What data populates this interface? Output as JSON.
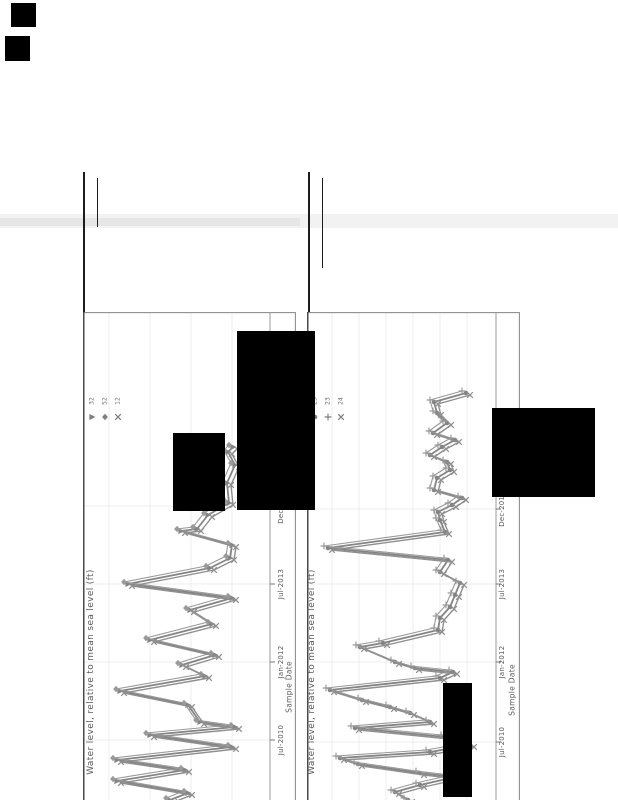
{
  "page": {
    "width": 618,
    "height": 800,
    "background": "#ffffff"
  },
  "colors": {
    "line_gray": "#868686",
    "marker_gray": "#7f7f7f",
    "border_gray": "#8e8e8e",
    "dark_edge": "#3a3a3a",
    "grid_light": "#efece8",
    "text_gray": "#575757",
    "redaction": "#000000"
  },
  "scan_artifacts": {
    "redaction_boxes": [
      {
        "x": 11,
        "y": 3,
        "w": 25,
        "h": 24
      },
      {
        "x": 5,
        "y": 36,
        "w": 25,
        "h": 25
      },
      {
        "x": 237,
        "y": 331,
        "w": 78,
        "h": 179
      },
      {
        "x": 173,
        "y": 433,
        "w": 52,
        "h": 78
      },
      {
        "x": 492,
        "y": 408,
        "w": 103,
        "h": 89
      },
      {
        "x": 443,
        "y": 683,
        "w": 29,
        "h": 114
      }
    ],
    "vertical_rules": [
      {
        "x": 83,
        "y": 172,
        "w": 1.5,
        "h": 140
      },
      {
        "x": 97,
        "y": 178,
        "w": 1.2,
        "h": 49
      },
      {
        "x": 308,
        "y": 172,
        "w": 1.5,
        "h": 140
      },
      {
        "x": 322,
        "y": 178,
        "w": 1.2,
        "h": 90
      }
    ],
    "gray_band": {
      "x": 0,
      "y": 214,
      "w": 618,
      "h": 14,
      "color": "#f2f2f2",
      "left_segment": {
        "x": 0,
        "y": 4,
        "w": 300,
        "h": 8,
        "color": "#e6e6e6"
      }
    }
  },
  "chart_data": [
    {
      "type": "line",
      "orientation": "rotated 90deg counterclockwise; time axis runs bottom-to-top of page",
      "box": {
        "x": 83,
        "y": 312,
        "w": 212,
        "h": 488
      },
      "axis_x": 270,
      "ylabel": "Water level, relative to mean sea level (ft)",
      "ylabel_pos": {
        "cx": 91,
        "cy": 672
      },
      "xlabel": "Sample Date",
      "xlabel_pos": {
        "cx": 289,
        "cy": 687
      },
      "tick_label_cx": 281,
      "tick_labels": [
        {
          "label": "Jul-2010",
          "y": 740
        },
        {
          "label": "Jan-2012",
          "y": 662
        },
        {
          "label": "Jul-2013",
          "y": 584
        },
        {
          "label": "Dec-2014",
          "y": 506
        }
      ],
      "gridlines_x": [
        109,
        150,
        191,
        232
      ],
      "legend": {
        "x": 86,
        "y": 411,
        "label_cy": 401,
        "step": 13,
        "entries": [
          {
            "marker": "triangle-right",
            "label": "32"
          },
          {
            "marker": "diamond",
            "label": "52"
          },
          {
            "marker": "x",
            "label": "12"
          }
        ]
      },
      "series": [
        {
          "name": "32",
          "marker": "triangle-right",
          "dx": 0,
          "dy": 0,
          "color": "#848484",
          "width": 1.8
        },
        {
          "name": "52",
          "marker": "diamond",
          "dx": -4,
          "dy": -2,
          "color": "#9a9a9a",
          "width": 1.1
        },
        {
          "name": "12",
          "marker": "x",
          "dx": 4,
          "dy": 2,
          "color": "#8f8f8f",
          "width": 1.4
        }
      ],
      "points": [
        [
          233,
          447
        ],
        [
          228,
          452
        ],
        [
          235,
          465
        ],
        [
          227,
          483
        ],
        [
          229,
          503
        ],
        [
          208,
          515
        ],
        [
          197,
          529
        ],
        [
          181,
          531
        ],
        [
          232,
          545
        ],
        [
          230,
          558
        ],
        [
          210,
          568
        ],
        [
          128,
          584
        ],
        [
          232,
          598
        ],
        [
          190,
          610
        ],
        [
          212,
          624
        ],
        [
          150,
          640
        ],
        [
          215,
          655
        ],
        [
          182,
          665
        ],
        [
          205,
          676
        ],
        [
          120,
          691
        ],
        [
          188,
          705
        ],
        [
          200,
          722
        ],
        [
          235,
          727
        ],
        [
          150,
          735
        ],
        [
          232,
          747
        ],
        [
          117,
          760
        ],
        [
          185,
          770
        ],
        [
          117,
          781
        ],
        [
          188,
          793
        ],
        [
          170,
          800
        ]
      ]
    },
    {
      "type": "line",
      "orientation": "rotated 90deg counterclockwise; time axis runs bottom-to-top of page",
      "box": {
        "x": 307,
        "y": 312,
        "w": 212,
        "h": 488
      },
      "axis_x": 496,
      "ylabel": "Water level, relative to mean sea level (ft)",
      "ylabel_pos": {
        "cx": 312,
        "cy": 672
      },
      "xlabel": "Sample Date",
      "xlabel_pos": {
        "cx": 512,
        "cy": 690
      },
      "tick_label_cx": 502,
      "tick_labels": [
        {
          "label": "Jul-2010",
          "y": 742
        },
        {
          "label": "Jan-2012",
          "y": 662
        },
        {
          "label": "Jul-2013",
          "y": 584
        },
        {
          "label": "Dec-2014",
          "y": 509
        }
      ],
      "gridlines_x": [
        332,
        359,
        386,
        413,
        440,
        467
      ],
      "legend": {
        "x": 309,
        "y": 411,
        "label_cy": 401,
        "step": 13,
        "entries": [
          {
            "marker": "circle",
            "label": "23"
          },
          {
            "marker": "plus",
            "label": "23"
          },
          {
            "marker": "x",
            "label": "24"
          }
        ]
      },
      "series": [
        {
          "name": "23",
          "marker": "circle",
          "dx": 0,
          "dy": 0,
          "color": "#848484",
          "width": 1.8
        },
        {
          "name": "23",
          "marker": "plus",
          "dx": -4,
          "dy": -2,
          "color": "#9a9a9a",
          "width": 1.1
        },
        {
          "name": "24",
          "marker": "x",
          "dx": 4,
          "dy": 2,
          "color": "#8f8f8f",
          "width": 1.4
        }
      ],
      "points": [
        [
          466,
          393
        ],
        [
          434,
          402
        ],
        [
          437,
          413
        ],
        [
          447,
          423
        ],
        [
          433,
          433
        ],
        [
          455,
          440
        ],
        [
          442,
          447
        ],
        [
          430,
          455
        ],
        [
          447,
          462
        ],
        [
          450,
          470
        ],
        [
          437,
          478
        ],
        [
          434,
          490
        ],
        [
          462,
          498
        ],
        [
          452,
          505
        ],
        [
          438,
          512
        ],
        [
          440,
          520
        ],
        [
          445,
          532
        ],
        [
          328,
          548
        ],
        [
          448,
          560
        ],
        [
          440,
          572
        ],
        [
          460,
          583
        ],
        [
          455,
          595
        ],
        [
          450,
          607
        ],
        [
          440,
          618
        ],
        [
          438,
          630
        ],
        [
          383,
          643
        ],
        [
          360,
          647
        ],
        [
          395,
          662
        ],
        [
          415,
          668
        ],
        [
          453,
          672
        ],
        [
          440,
          678
        ],
        [
          330,
          690
        ],
        [
          362,
          700
        ],
        [
          390,
          707
        ],
        [
          410,
          713
        ],
        [
          430,
          722
        ],
        [
          355,
          728
        ],
        [
          445,
          737
        ],
        [
          470,
          745
        ],
        [
          430,
          752
        ],
        [
          340,
          758
        ],
        [
          358,
          764
        ],
        [
          420,
          773
        ],
        [
          455,
          777
        ],
        [
          420,
          785
        ],
        [
          395,
          792
        ],
        [
          408,
          800
        ]
      ]
    }
  ]
}
